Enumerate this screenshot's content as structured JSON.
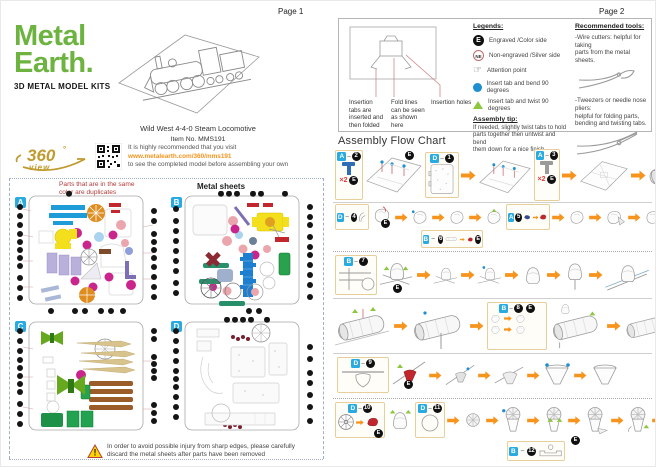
{
  "page1": {
    "page_label": "Page 1",
    "logo": {
      "word1": "Metal",
      "word2": "Earth.",
      "tagline": "3D METAL MODEL KITS"
    },
    "model_name": "Wild West 4-4-0 Steam Locomotive",
    "item_no": "Item No. MMS191",
    "view360": {
      "badge_number": "360",
      "badge_degree": "°",
      "badge_view": "view",
      "line1": "It is highly recommended that you visit",
      "url": "www.metalearth.com/360/mms191",
      "line2": "to see the completed model before assembling your own"
    },
    "duplicates_note_line1": "Parts that are in the same",
    "duplicates_note_line2": "color are duplicates",
    "metal_sheets_title": "Metal sheets",
    "sheet_labels": {
      "a": "A",
      "b": "B",
      "c": "C",
      "d": "D"
    },
    "warning_line1": "In order to avoid possible injury from sharp edges, please carefully",
    "warning_line2": "discard the metal sheets after parts have been removed",
    "warning_mark": "!"
  },
  "page2": {
    "page_label": "Page 2",
    "dash": "–",
    "marker_e": "E",
    "insertion_labels": {
      "tabs": "Insertion tabs are inserted and then folded",
      "fold": "Fold lines can be seen as shown here",
      "holes": "Insertion holes"
    },
    "legends": {
      "title": "Legends:",
      "engraved_symbol": "E",
      "engraved": "Engraved /Color side",
      "non_engraved_symbol": "NE",
      "non_engraved": "Non-engraved /Silver side",
      "attention_icon": "☞",
      "attention": "Attention point",
      "bend": "Insert tab and bend 90 degrees",
      "twist": "Insert tab and twist 90 degrees"
    },
    "assembly_tip": {
      "title": "Assembly tip:",
      "line1": "If needed, slightly twist tabs to hold",
      "line2": "parts together then untwist and bend",
      "line3": "them down for a nice finish"
    },
    "tools": {
      "title": "Recommended tools:",
      "wire_line1": "-Wire cutters: helpful for taking",
      "wire_line2": "parts from the metal sheets.",
      "tweezer_line1": "-Tweezers or needle nose pliers:",
      "tweezer_line2": "helpful for folding parts,",
      "tweezer_line3": "bending and twisting tabs."
    },
    "flow_title": "Assembly Flow Chart",
    "steps": {
      "s1": {
        "sheet": "A",
        "num": "2",
        "qty": "×2"
      },
      "s2": {
        "sheet": "D",
        "num": "1"
      },
      "s3": {
        "sheet": "A",
        "num": "3",
        "qty": "×2"
      },
      "s4": {
        "sheet": "D",
        "num": "4"
      },
      "s5": {
        "sheet": "A",
        "num": "5"
      },
      "s6": {
        "sheet": "B",
        "num": "6"
      },
      "s7": {
        "sheet": "B",
        "num": "7"
      },
      "s8": {
        "sheet": "B",
        "num": "8"
      },
      "s9": {
        "sheet": "D",
        "num": "9"
      },
      "s10": {
        "sheet": "D",
        "num": "10"
      },
      "s11": {
        "sheet": "D",
        "num": "11"
      },
      "s12": {
        "sheet": "B",
        "num": "12"
      }
    }
  },
  "colors": {
    "logo_green": "#6cb33f",
    "gold": "#bf9b30",
    "orange_arrow": "#f7941d",
    "url_orange": "#f7941d",
    "red_note": "#b13a3a",
    "sheet_label_blue": "#29abe2",
    "accent_red": "#c1272d",
    "bend_blue": "#1f8fd0",
    "twist_green": "#8dc63f",
    "warning_yellow": "#ffd400"
  }
}
